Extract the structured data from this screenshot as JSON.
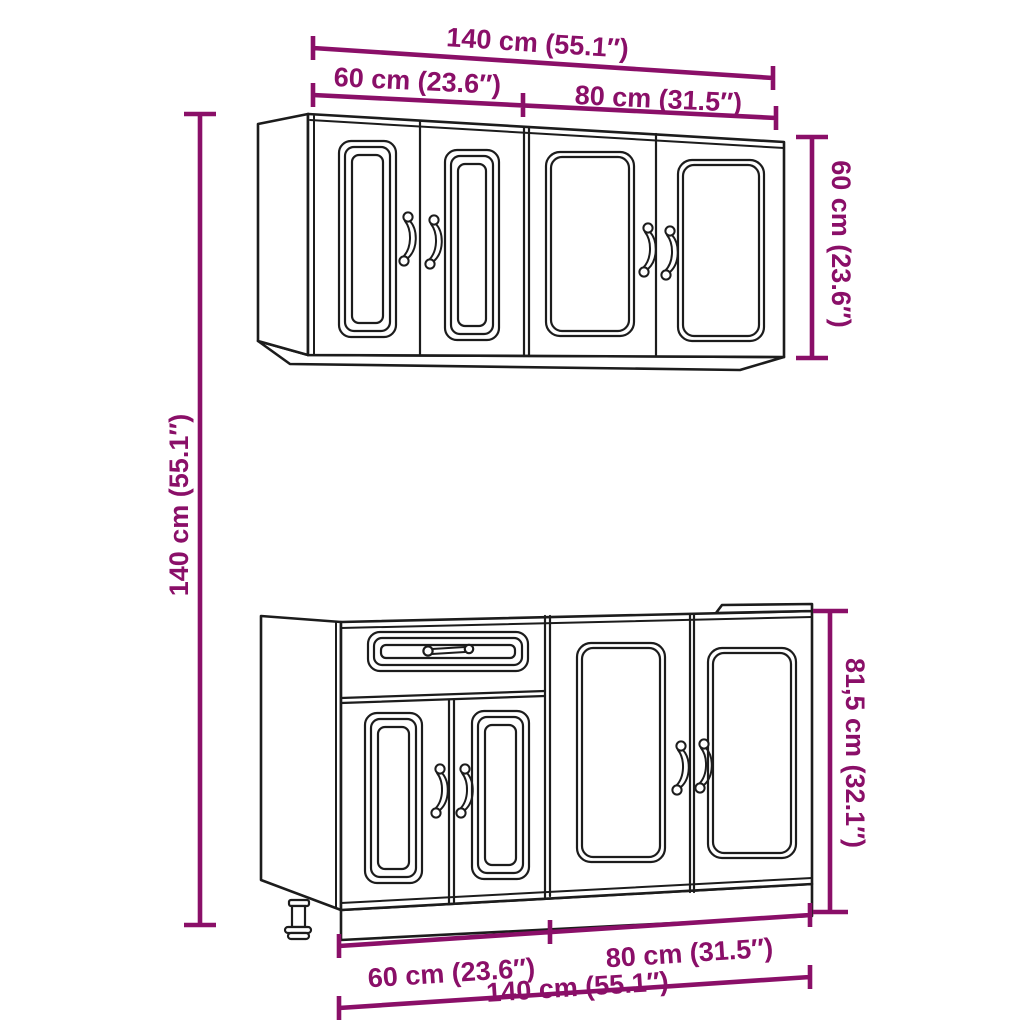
{
  "theme": {
    "dimension_color": "#8a0f68",
    "line_color": "#1c1c1c",
    "background": "#ffffff"
  },
  "diagram": {
    "dimensions": {
      "top_total_width": "140 cm (55.1″)",
      "top_section_left_width": "60 cm (23.6″)",
      "top_section_right_width": "80 cm (31.5″)",
      "wall_cabinet_height": "60 cm (23.6″)",
      "overall_height": "140 cm (55.1″)",
      "base_cabinet_height": "81,5 cm (32.1″)",
      "bottom_section_left_width": "60 cm (23.6″)",
      "bottom_section_right_width": "80 cm (31.5″)",
      "bottom_total_width": "140 cm (55.1″)"
    }
  }
}
